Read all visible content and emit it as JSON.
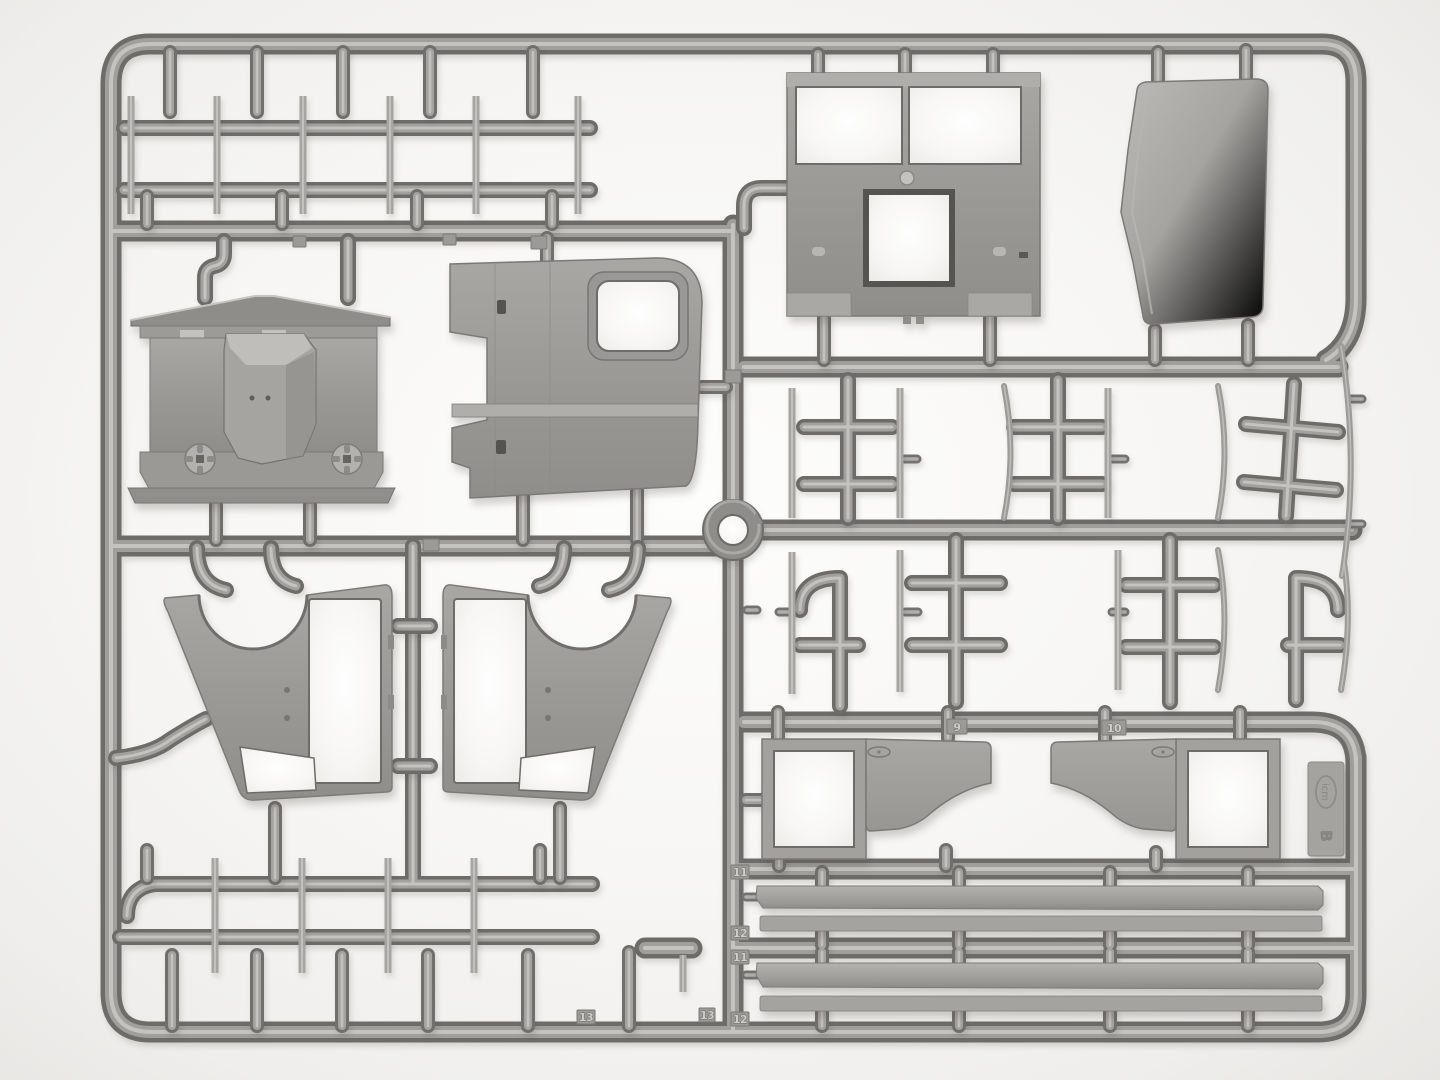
{
  "image": {
    "type": "photograph",
    "subject": "Gray polystyrene injection-molded model-kit sprue (parts frame) with truck cab parts on a white background",
    "sprue_letter": "B",
    "brand_mark": "icm",
    "background_color": "#f1f0ee",
    "plastic_base_color": "#9f9d9a",
    "plastic_highlight_color": "#c9c7c3",
    "plastic_shadow_color": "#6e6c69"
  },
  "tag": {
    "logo": "icm",
    "letter": "B"
  },
  "tabs": {
    "door_left": "9",
    "door_right": "10",
    "running_board_1": "11",
    "running_board_2": "12",
    "running_board_3": "11",
    "running_board_4": "12",
    "slat_set_left": "13",
    "slat_set_right": "13"
  },
  "parts": [
    "bed-slat-strip (x10 on two ladder runners)",
    "cab-firewall-with-engine-cover",
    "cab-door-rear-panel-with-window",
    "cab-front-panel-with-two-windshield-openings",
    "cab-roof-panel",
    "cab-side-panel-left",
    "cab-side-panel-right",
    "door-lower-half-left",
    "door-lower-half-right",
    "running-board-strip (x4)",
    "axle-cross-rod-cluster (x5)",
    "leaf-spring-blade (x8)",
    "exhaust-elbow-pipe (x2)",
    "injection-gate-ring",
    "icm-logo-tag"
  ]
}
